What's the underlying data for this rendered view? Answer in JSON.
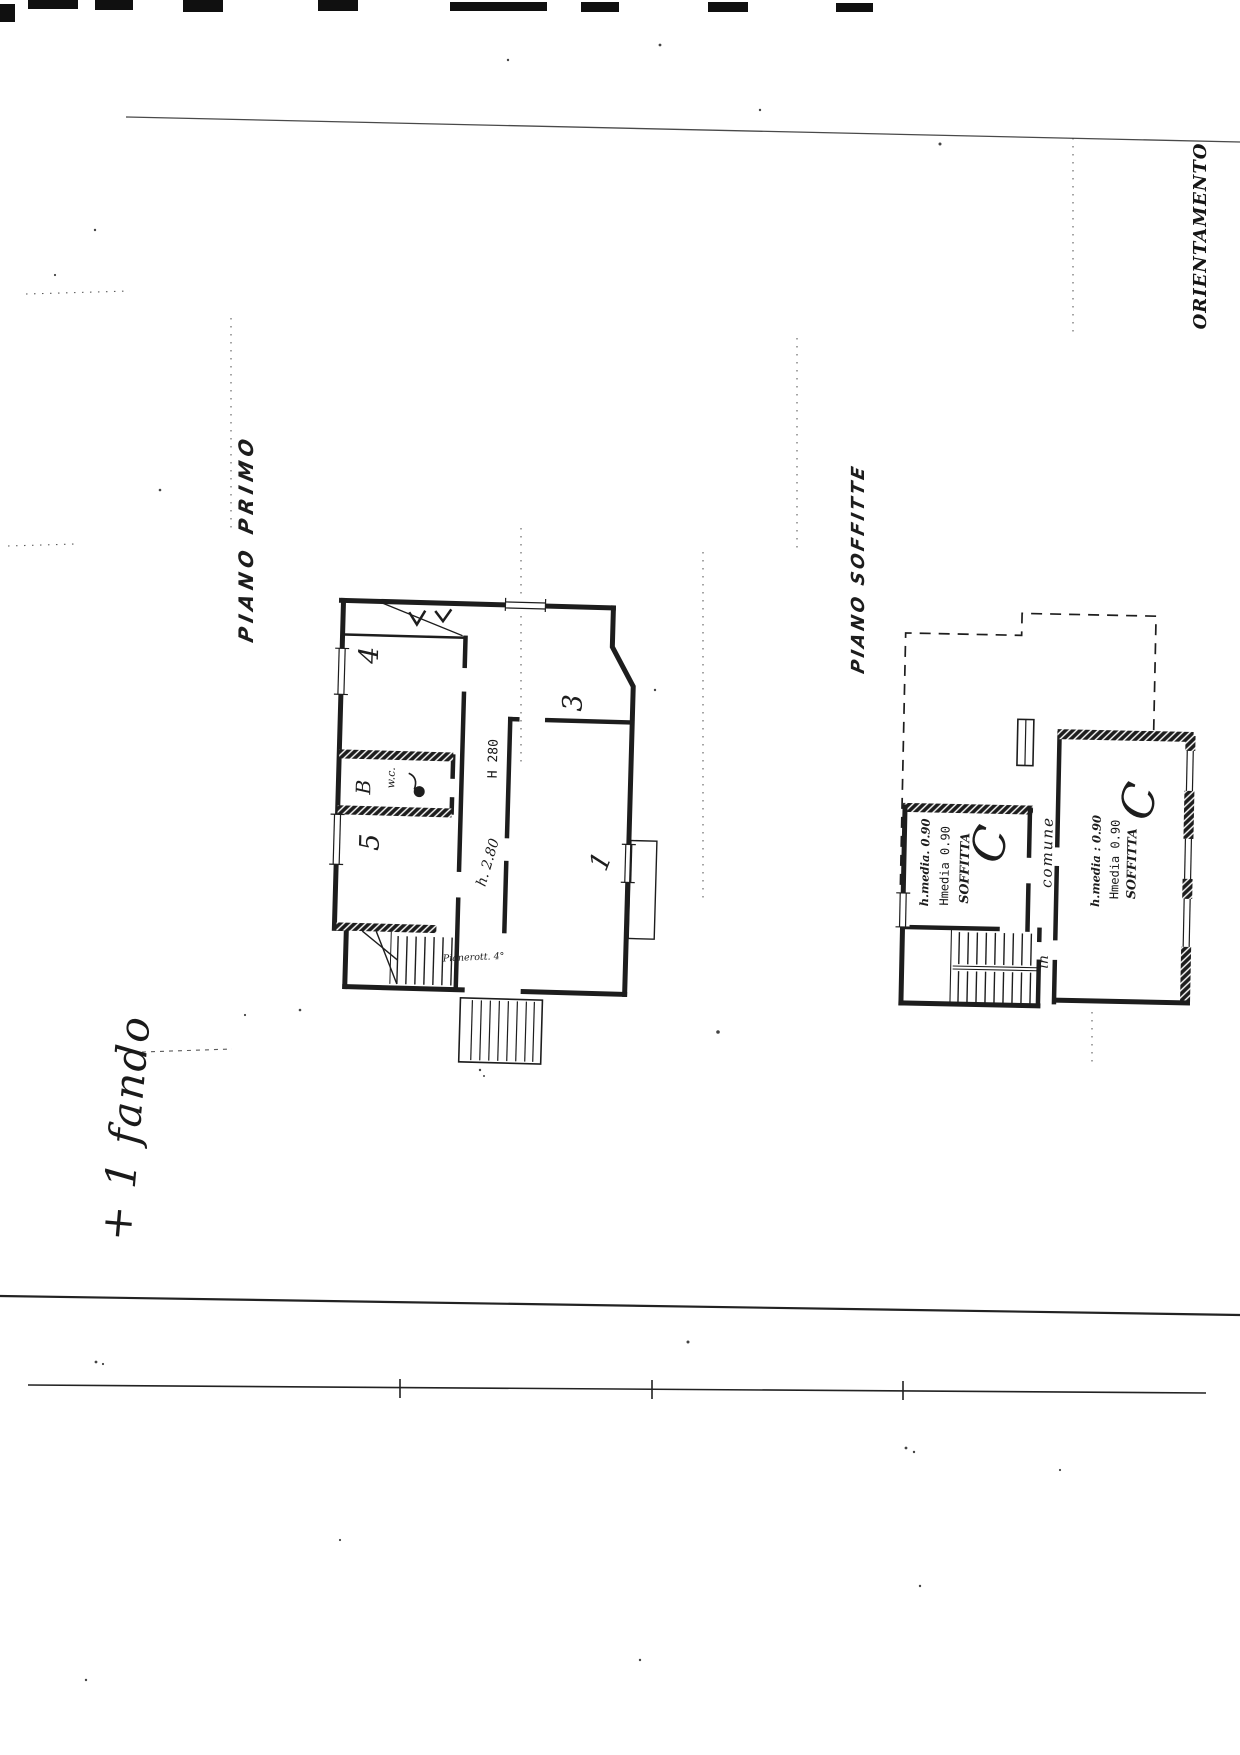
{
  "labels": {
    "plan1_title": "PIANO PRIMO",
    "plan2_title": "PIANO SOFFITTE",
    "orientation": "ORIENTAMENTO",
    "handwritten_note": "+ 1 fando"
  },
  "plan1": {
    "room_numbers": {
      "room1": "1",
      "room3": "3",
      "room4": "4",
      "room5": "5",
      "bath": "B",
      "wc": "w.c."
    },
    "height_typed": "H 280",
    "height_hand": "h. 2.80",
    "stair_note": "Pianerott. 4°"
  },
  "plan2": {
    "left_room": {
      "height_hand": "h.media. 0.90",
      "height_typed": "Hmedia 0.90",
      "room_name": "SOFFITTA",
      "flourish": "C"
    },
    "right_room": {
      "height_hand": "h.media : 0.90",
      "height_typed": "Hmedia 0.90",
      "room_name": "SOFFITTA",
      "flourish": "C"
    },
    "stair_shared_word1": "in",
    "stair_shared_word2": "comune"
  },
  "colors": {
    "ink": "#1d1d1d",
    "paper": "#ffffff"
  }
}
